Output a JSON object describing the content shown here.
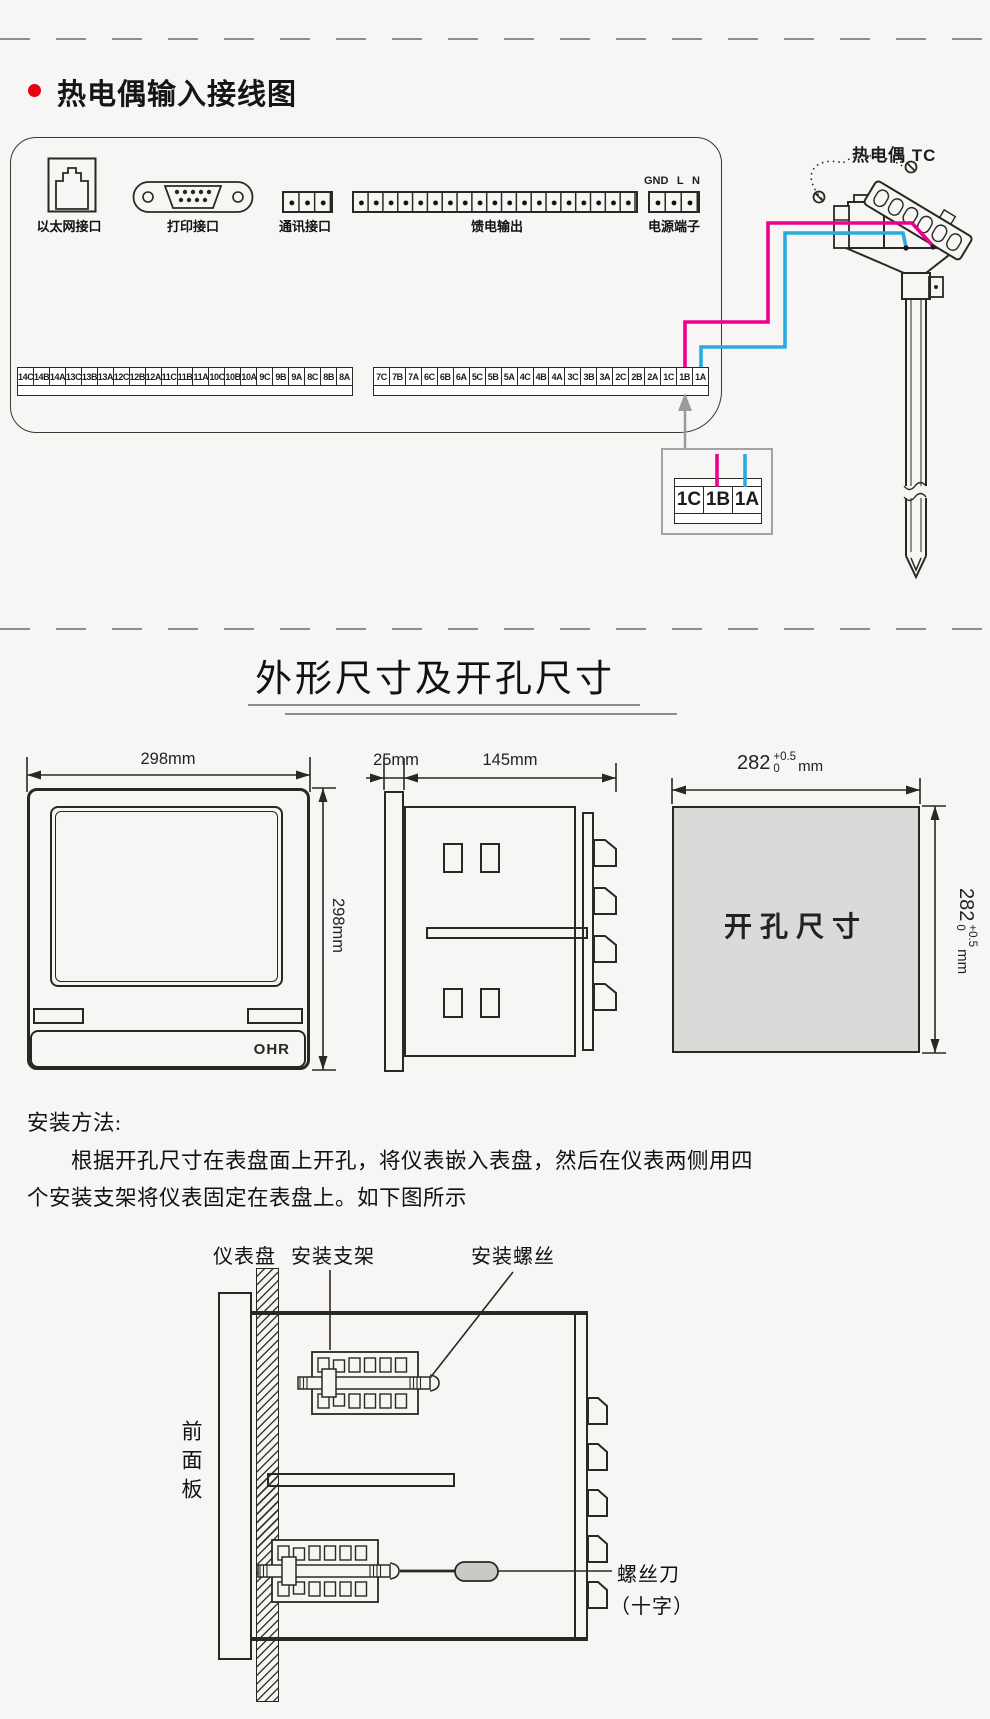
{
  "wiring": {
    "title": "热电偶输入接线图",
    "tc_label": "热电偶 TC",
    "port_labels": {
      "ethernet": "以太网接口",
      "printer": "打印接口",
      "comm": "通讯接口",
      "feed": "馈电输出",
      "power": "电源端子"
    },
    "power_pins": [
      "GND",
      "L",
      "N"
    ],
    "terminals_left": [
      "14C",
      "14B",
      "14A",
      "13C",
      "13B",
      "13A",
      "12C",
      "12B",
      "12A",
      "11C",
      "11B",
      "11A",
      "10C",
      "10B",
      "10A",
      "9C",
      "9B",
      "9A",
      "8C",
      "8B",
      "8A"
    ],
    "terminals_right": [
      "7C",
      "7B",
      "7A",
      "6C",
      "6B",
      "6A",
      "5C",
      "5B",
      "5A",
      "4C",
      "4B",
      "4A",
      "3C",
      "3B",
      "3A",
      "2C",
      "2B",
      "2A",
      "1C",
      "1B",
      "1A"
    ],
    "detail_terminals": [
      "1C",
      "1B",
      "1A"
    ],
    "colors": {
      "wire_positive": "#ec008c",
      "wire_negative": "#29abe2",
      "bullet": "#e60012"
    }
  },
  "dims": {
    "title": "外形尺寸及开孔尺寸",
    "front_width": "298mm",
    "front_height": "298mm",
    "bezel_depth": "25mm",
    "body_depth": "145mm",
    "cutout_text": "开孔尺寸",
    "cutout_value": "282",
    "cutout_tol_plus": "+0.5",
    "cutout_tol_minus": "0",
    "cutout_unit": "mm",
    "brand": "OHR"
  },
  "install": {
    "heading": "安装方法:",
    "para_line1": "根据开孔尺寸在表盘面上开孔，将仪表嵌入表盘，然后在仪表两侧用四",
    "para_line2": "个安装支架将仪表固定在表盘上。如下图所示",
    "label_panel": "仪表盘",
    "label_bracket": "安装支架",
    "label_screw": "安装螺丝",
    "label_front_panel": "前面板",
    "label_screwdriver_1": "螺丝刀",
    "label_screwdriver_2": "（十字）"
  }
}
